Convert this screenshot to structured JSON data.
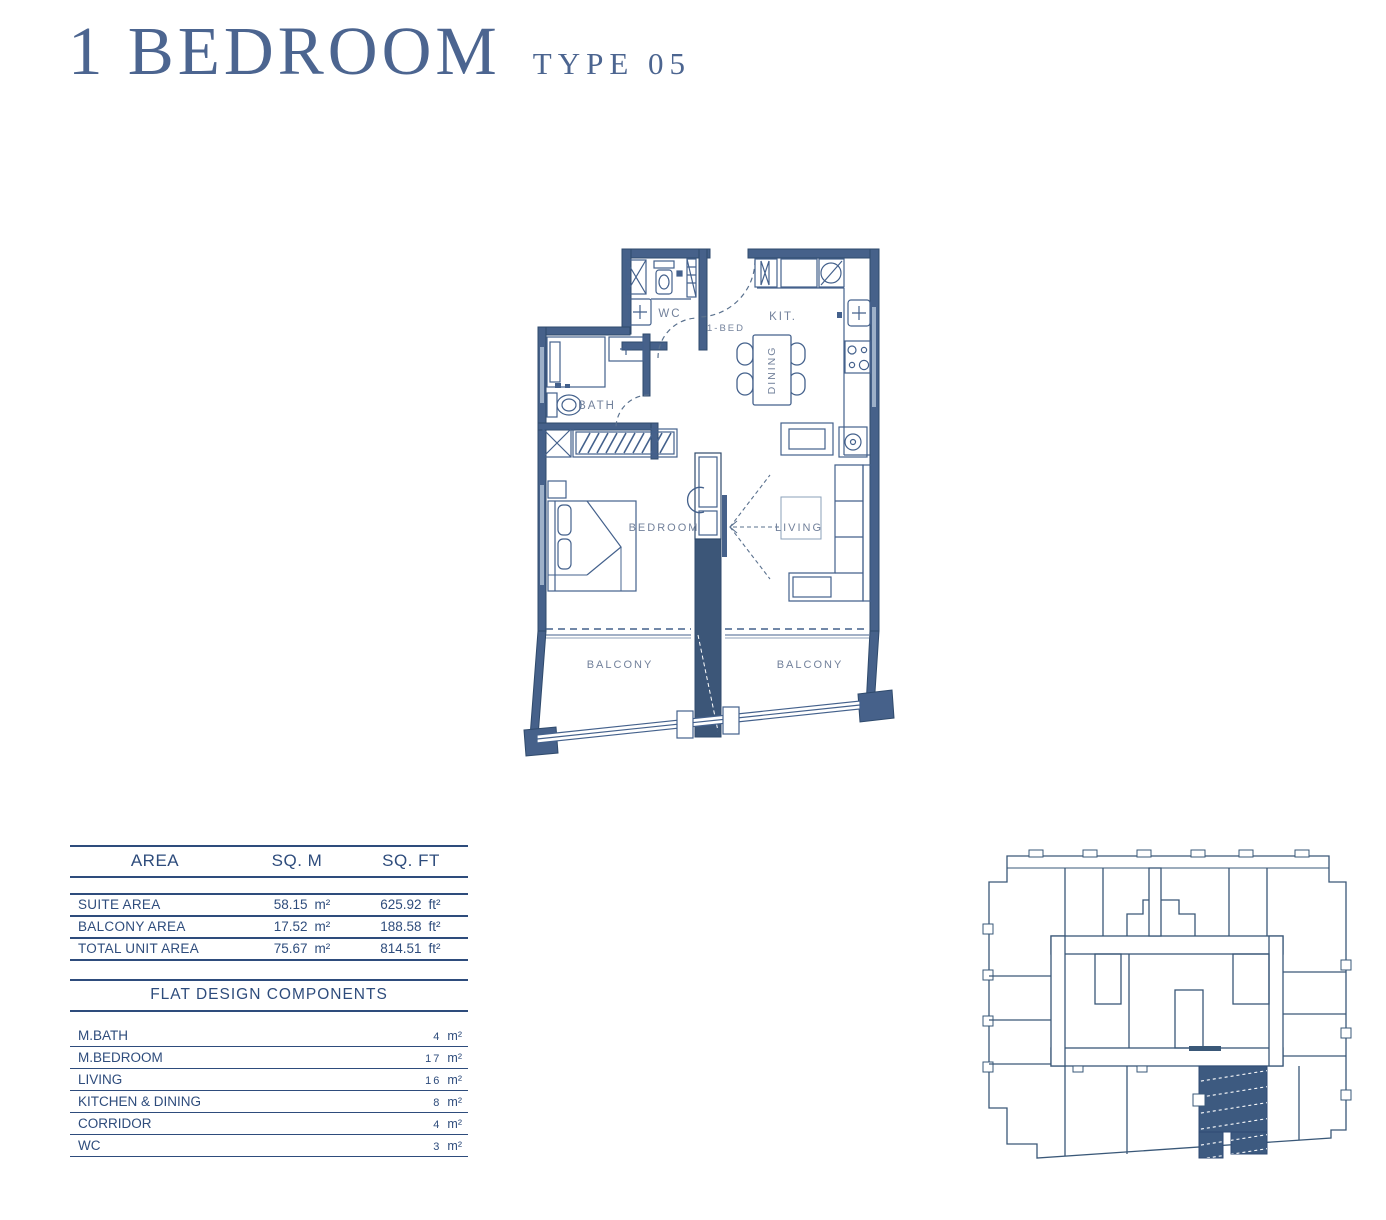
{
  "header": {
    "title": "1 BEDROOM",
    "subtitle": "TYPE 05"
  },
  "floor_plan": {
    "labels": {
      "wc": "WC",
      "unit": "1-BED",
      "kitchen": "KIT.",
      "dining": "DINING",
      "bath": "BATH",
      "bedroom": "BEDROOM",
      "living": "LIVING",
      "balcony_left": "BALCONY",
      "balcony_right": "BALCONY"
    }
  },
  "area_table": {
    "headers": {
      "area": "AREA",
      "sqm": "SQ. M",
      "sqft": "SQ. FT"
    },
    "rows": [
      {
        "label": "SUITE AREA",
        "sqm": "58.15",
        "sqm_unit": "m²",
        "sqft": "625.92",
        "sqft_unit": "ft²"
      },
      {
        "label": "BALCONY AREA",
        "sqm": "17.52",
        "sqm_unit": "m²",
        "sqft": "188.58",
        "sqft_unit": "ft²"
      },
      {
        "label": "TOTAL UNIT AREA",
        "sqm": "75.67",
        "sqm_unit": "m²",
        "sqft": "814.51",
        "sqft_unit": "ft²"
      }
    ]
  },
  "components_table": {
    "title": "FLAT DESIGN COMPONENTS",
    "rows": [
      {
        "label": "M.BATH",
        "value": "4",
        "unit": "m²"
      },
      {
        "label": "M.BEDROOM",
        "value": "17",
        "unit": "m²"
      },
      {
        "label": "LIVING",
        "value": "16",
        "unit": "m²"
      },
      {
        "label": "KITCHEN & DINING",
        "value": "8",
        "unit": "m²"
      },
      {
        "label": "CORRIDOR",
        "value": "4",
        "unit": "m²"
      },
      {
        "label": "WC",
        "value": "3",
        "unit": "m²"
      }
    ]
  },
  "colors": {
    "title_blue": "#4c6590",
    "table_navy": "#2e4c7c",
    "plan_wall": "#46618a",
    "plan_label": "#72819b",
    "keyplan_highlight": "#3d5a80"
  }
}
